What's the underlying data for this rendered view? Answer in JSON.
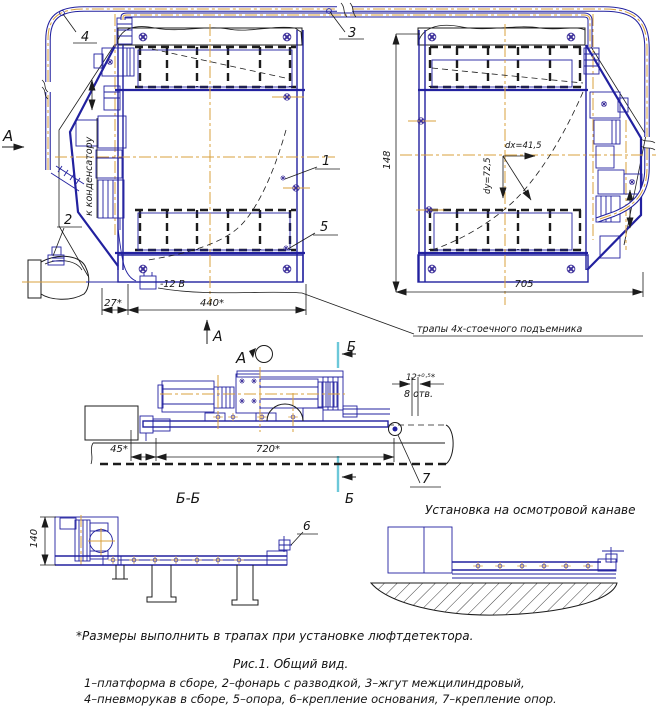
{
  "colors": {
    "line_blue": "#22219f",
    "line_black": "#1c1c1c",
    "centerline_orange": "#d9a13c",
    "section_cut_cyan": "#6cc8d9",
    "bolt_purple": "#3c2f9a"
  },
  "callouts": {
    "n1": "1",
    "n2": "2",
    "n3": "3",
    "n4": "4",
    "n5": "5",
    "n6": "6",
    "n7": "7"
  },
  "view_markers": {
    "a_side": "А",
    "a_up": "А",
    "a_rot": "А",
    "b_top": "Б",
    "b_bot": "Б"
  },
  "section_titles": {
    "bb": "Б-Б",
    "install": "Установка на осмотровой канаве"
  },
  "dimensions": {
    "d27": "27*",
    "d440": "440*",
    "d148": "148",
    "d705": "705",
    "d45": "45*",
    "d720": "720*",
    "d140": "140",
    "dx": "dх=41,5",
    "dy": "dу=72,5",
    "hole": "12⁺⁰·⁵*",
    "holes_count": "8 отв.",
    "voltage": "-12 В"
  },
  "notes": {
    "condenser": "к конденсатору",
    "ramps": "трапы 4х-стоечного подъемника",
    "footnote": "*Размеры выполнить в трапах при установке люфтдетектора."
  },
  "caption": {
    "figure": "Рис.1. Общий вид.",
    "legend1": "1–платформа в сборе, 2–фонарь с разводкой, 3–жгут межцилиндровый,",
    "legend2": "4–пневморукав в сборе, 5–опора, 6–крепление основания, 7–крепление опор."
  }
}
